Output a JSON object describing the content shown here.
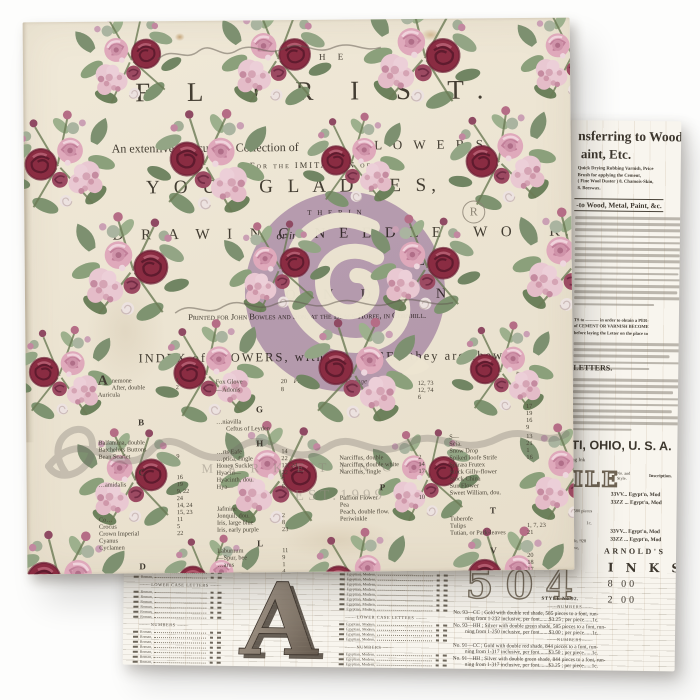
{
  "watermark": {
    "marketing": "MARKETING",
    "established": "EST.1999",
    "registered_symbol": "R"
  },
  "front_sheet": {
    "the": "H E",
    "title": "F L O R I S T.",
    "subtitle_left": "An extenfive and curious Collection of",
    "subtitle_flowers": "F L O W E R S,",
    "imitation_line": "For the IMITATION of",
    "young_ladies": "Y O U N G   L A D I E S,",
    "either_in": "T H E R   I N",
    "drawing": "D R A W I N G,",
    "or_in": "or in",
    "needlework": "N E E D L E - W O R K.",
    "frag_h": "H",
    "frag_l": "L",
    "london": "L O N D O N",
    "imprint": "Printed for John Bowles and Son, at the Black Horfe, in Cornhill.",
    "index_heading": "INDEX of FLOWERS, with the PAGES they are fhewn.",
    "page_label_1": "Page.",
    "page_label_2": "Page.",
    "orange_script": "Orange",
    "index_columns": [
      {
        "x": 72,
        "numx": 150,
        "rows": [
          {
            "s": "A",
            "y": 352,
            "drop": true
          },
          {
            "n": "nemone",
            "p": "1",
            "y": 356,
            "xo": 14
          },
          {
            "n": "After, double",
            "p": "2",
            "y": 363,
            "xo": 14
          },
          {
            "n": "Auricula",
            "p": "",
            "y": 370
          },
          {
            "s": "B",
            "y": 396
          },
          {
            "n": "Balfamina, double",
            "p": "",
            "y": 418
          },
          {
            "n": "Batchelors Buttons",
            "p": "",
            "y": 425
          },
          {
            "n": "Bean Scarlet",
            "p": "9",
            "y": 432
          },
          {
            "s": "C",
            "y": 446
          },
          {
            "n": "",
            "p": "16",
            "y": 453
          },
          {
            "n": "…amidalis",
            "p": "19",
            "y": 460
          },
          {
            "n": "",
            "p": "9, 22",
            "y": 467
          },
          {
            "n": "",
            "p": "24",
            "y": 474
          },
          {
            "n": "",
            "p": "14, 24",
            "y": 481
          },
          {
            "n": "",
            "p": "15, 23",
            "y": 488
          },
          {
            "n": "Co…",
            "p": "11",
            "y": 495
          },
          {
            "n": "Crocus",
            "p": "5",
            "y": 502
          },
          {
            "n": "Crown Imperial",
            "p": "22",
            "y": 509
          },
          {
            "n": "Cyanus",
            "p": "",
            "y": 516
          },
          {
            "n": "Cyclamen",
            "p": "",
            "y": 523
          },
          {
            "s": "D",
            "y": 540
          }
        ]
      },
      {
        "x": 190,
        "numx": 255,
        "rows": [
          {
            "n": "Fox Glove",
            "p": "20",
            "y": 358
          },
          {
            "n": "—Adonis",
            "p": "8",
            "y": 366
          },
          {
            "s": "G",
            "y": 384
          },
          {
            "n": "…niavilla",
            "p": "",
            "y": 398
          },
          {
            "n": "Ceftus of Leyden",
            "p": "",
            "y": 405,
            "xo": 10
          },
          {
            "s": "H",
            "y": 418
          },
          {
            "n": "…rts Eafe",
            "p": "14",
            "y": 428
          },
          {
            "n": "…ptica, fingle",
            "p": "22",
            "y": 435
          },
          {
            "n": "Honey Suckle",
            "p": "13, 24",
            "y": 442
          },
          {
            "n": "Hyacin—",
            "p": "22",
            "y": 449
          },
          {
            "n": "Hyacinth, dou.",
            "p": "7",
            "y": 456
          },
          {
            "n": "Hya—",
            "p": "6",
            "y": 463
          },
          {
            "n": "Jafmine",
            "p": "",
            "y": 485
          },
          {
            "n": "Jonquil, dou.",
            "p": "2",
            "y": 492
          },
          {
            "n": "Iris, large blue",
            "p": "8",
            "y": 499
          },
          {
            "n": "Iris, early purple",
            "p": "23",
            "y": 506
          },
          {
            "s": "L",
            "y": 518
          },
          {
            "n": "Laburnum",
            "p": "11",
            "y": 527
          },
          {
            "n": "—Spur, bee",
            "p": "9",
            "y": 534
          },
          {
            "n": "…arus",
            "p": "1",
            "y": 541
          },
          {
            "n": "",
            "p": "4",
            "y": 548
          }
        ]
      },
      {
        "x": 313,
        "numx": 392,
        "rows": [
          {
            "n": "",
            "p": "12, 73",
            "y": 361
          },
          {
            "n": "",
            "p": "12, 74",
            "y": 368
          },
          {
            "n": "",
            "p": "6",
            "y": 375
          },
          {
            "n": "Narciffus, double",
            "p": "2",
            "y": 435
          },
          {
            "n": "Narciffus, double white",
            "p": "14",
            "y": 442
          },
          {
            "n": "Narciffus, fingle",
            "p": "17",
            "y": 449
          },
          {
            "s": "P",
            "y": 463
          },
          {
            "n": "Paffion Flower",
            "p": "10",
            "y": 475
          },
          {
            "n": "Pea",
            "p": "",
            "y": 482
          },
          {
            "n": "Peach, double flow.",
            "p": "",
            "y": 489
          },
          {
            "n": "Periwinkle",
            "p": "",
            "y": 496
          }
        ]
      },
      {
        "x": 423,
        "numx": 500,
        "rows": [
          {
            "n": "",
            "p": "17",
            "y": 385
          },
          {
            "n": "",
            "p": "19",
            "y": 392
          },
          {
            "n": "",
            "p": "16",
            "y": 399
          },
          {
            "n": "",
            "p": "9",
            "y": 406
          },
          {
            "n": "S—",
            "p": "13",
            "y": 415
          },
          {
            "n": "Scia.",
            "p": "21",
            "y": 422
          },
          {
            "n": "Snow Drop",
            "p": "1",
            "y": 429
          },
          {
            "n": "Spiked loofe Strife",
            "p": "16",
            "y": 436
          },
          {
            "n": "Spiræa Frutex",
            "p": "",
            "y": 443
          },
          {
            "n": "Stock Gilly-flower",
            "p": "",
            "y": 450
          },
          {
            "n": "Stock China",
            "p": "",
            "y": 457
          },
          {
            "n": "Sun Flower",
            "p": "",
            "y": 464
          },
          {
            "n": "Sweet William, dou.",
            "p": "",
            "y": 471
          },
          {
            "s": "T",
            "y": 487
          },
          {
            "n": "Tuberofe",
            "p": "",
            "y": 497
          },
          {
            "n": "Tulips",
            "p": "1, 7, 23",
            "y": 504
          },
          {
            "n": "Tutian, or Park-leaves",
            "p": "21",
            "y": 511
          },
          {
            "s": "V",
            "y": 527
          },
          {
            "n": "",
            "p": "20",
            "y": 534
          },
          {
            "n": "",
            "p": "18",
            "y": 541
          },
          {
            "n": "",
            "p": "17",
            "y": 548
          }
        ]
      }
    ]
  },
  "back_sheet": {
    "headline_top": "nsferring to Wood,",
    "headline_sub": "aint, Etc.",
    "credit_lines": [
      "Quick Drying Rubbing Varnish,   Price",
      "Brush for applying the Cement,",
      "( Fine Wool Duster )        8.  Chamois-Skin,",
      "8.  Beeswax."
    ],
    "metal_heading": "-to Wood, Metal, Paint, &c.",
    "bold_fragments": [
      "TS to ——— in order to obtain a PER-",
      "of CEMENT OR VARNISH BECOME",
      "before laying the Letter on the place to"
    ],
    "letters_heading": "LETTERS.",
    "city_line": "TI, OHIO, U. S. A.",
    "ink_fragment": "ng Ink",
    "style_outline": "ILE",
    "spec_table": {
      "header_no": "No. and Style.",
      "header_inscription": "Inscription.",
      "rows": [
        {
          "no": "33VV...",
          "desc": "Egypt'n, Mod"
        },
        {
          "no": "33ZZ ...",
          "desc": "Egypt'n, Mod"
        }
      ]
    },
    "frag_L": "— L",
    "frag_N": "— N",
    "pieces_fragment": "580 pieces",
    "cent_fragment": "1c.",
    "shade_fragment": "ade, 928",
    "sive_fragment": "sive,",
    "arnolds": {
      "brand": "ARNOLD'S",
      "word": "I N K S",
      "price1": "8 00",
      "price2": "2 00"
    },
    "big_letter": "A",
    "big_number": "504",
    "style_no": "STYLE No 92.",
    "numbers_heading": "NUMBERS",
    "price_entries": [
      {
        "line1": "No. 93—CC ; Gold with double red shade, 585 pieces to a font, run-",
        "line2": "ning from 1-232 inclusive, per font.......$3.25 ; per piece......1c."
      },
      {
        "line1": "No. 93—HH ; Silver with double green shade, 585 pieces to a font, run-",
        "line2": "ning from 1-250 inclusive, per font.......$3.00 ; per piece......1c."
      },
      {
        "line1": "No. 91—CC ; Gold with double red shade, 844 pieces to a font, run-",
        "line2": "ning from 1-317 inclusive, per font.......$3.50 ; per piece......1c."
      },
      {
        "line1": "No. 91—HH ; Silver with double green shade, 844 pieces to a font, run-",
        "line2": "ning from 1-317 inclusive, per font.......$3.25 ; per piece......1c."
      }
    ],
    "ledger": {
      "heading_lower_case": "LOWER CASE LETTERS",
      "heading_numbers": "NUMBERS",
      "left_row_word": "Roman,",
      "mid_row_word": "Egyptian, Modern,"
    }
  },
  "colors": {
    "paper_cream": "#ece4d2",
    "newsprint": "#f8f5ee",
    "lavender_logo": "#ba9fcb",
    "rose_dark": "#8a2c42",
    "rose_pink": "#dfa9bb",
    "leaf_green": "#7d9070",
    "ink": "#433d32"
  }
}
